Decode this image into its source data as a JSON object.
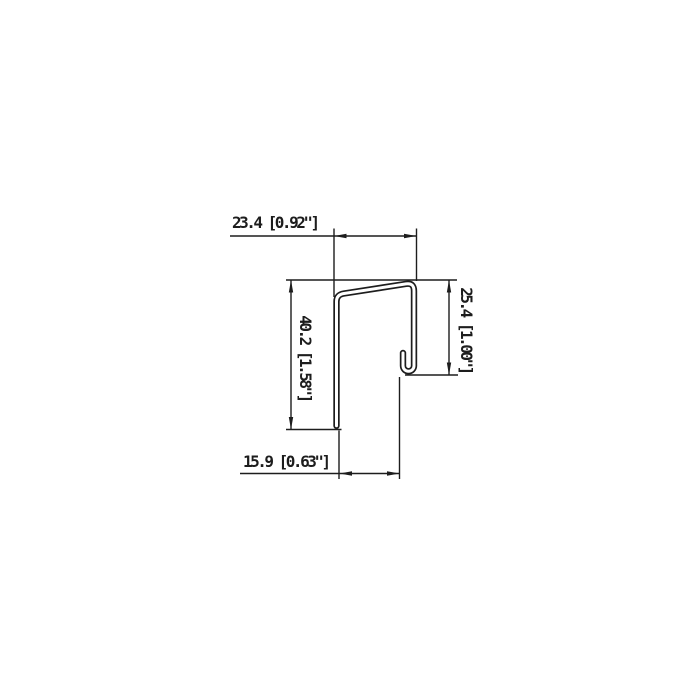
{
  "page": {
    "background": "#ffffff"
  },
  "drawing": {
    "kind": "sheet-metal profile cross-section (J-channel with hooked return leg)",
    "line_color": "#1d1d1d",
    "dimensions": {
      "top": {
        "label": "23.4 [0.92\"]",
        "value_mm": "23.4",
        "value_inch": "0.92\"",
        "measures": "overall width of profile"
      },
      "left": {
        "label": "40.2 [1.58\"]",
        "value_mm": "40.2",
        "value_inch": "1.58\"",
        "measures": "height of long left leg"
      },
      "right": {
        "label": "25.4 [1.00\"]",
        "value_mm": "25.4",
        "value_inch": "1.00\"",
        "measures": "height of right leg to bottom of hook"
      },
      "bottom": {
        "label": "15.9 [0.63\"]",
        "value_mm": "15.9",
        "value_inch": "0.63\"",
        "measures": "inside width from left leg to hook"
      }
    }
  }
}
